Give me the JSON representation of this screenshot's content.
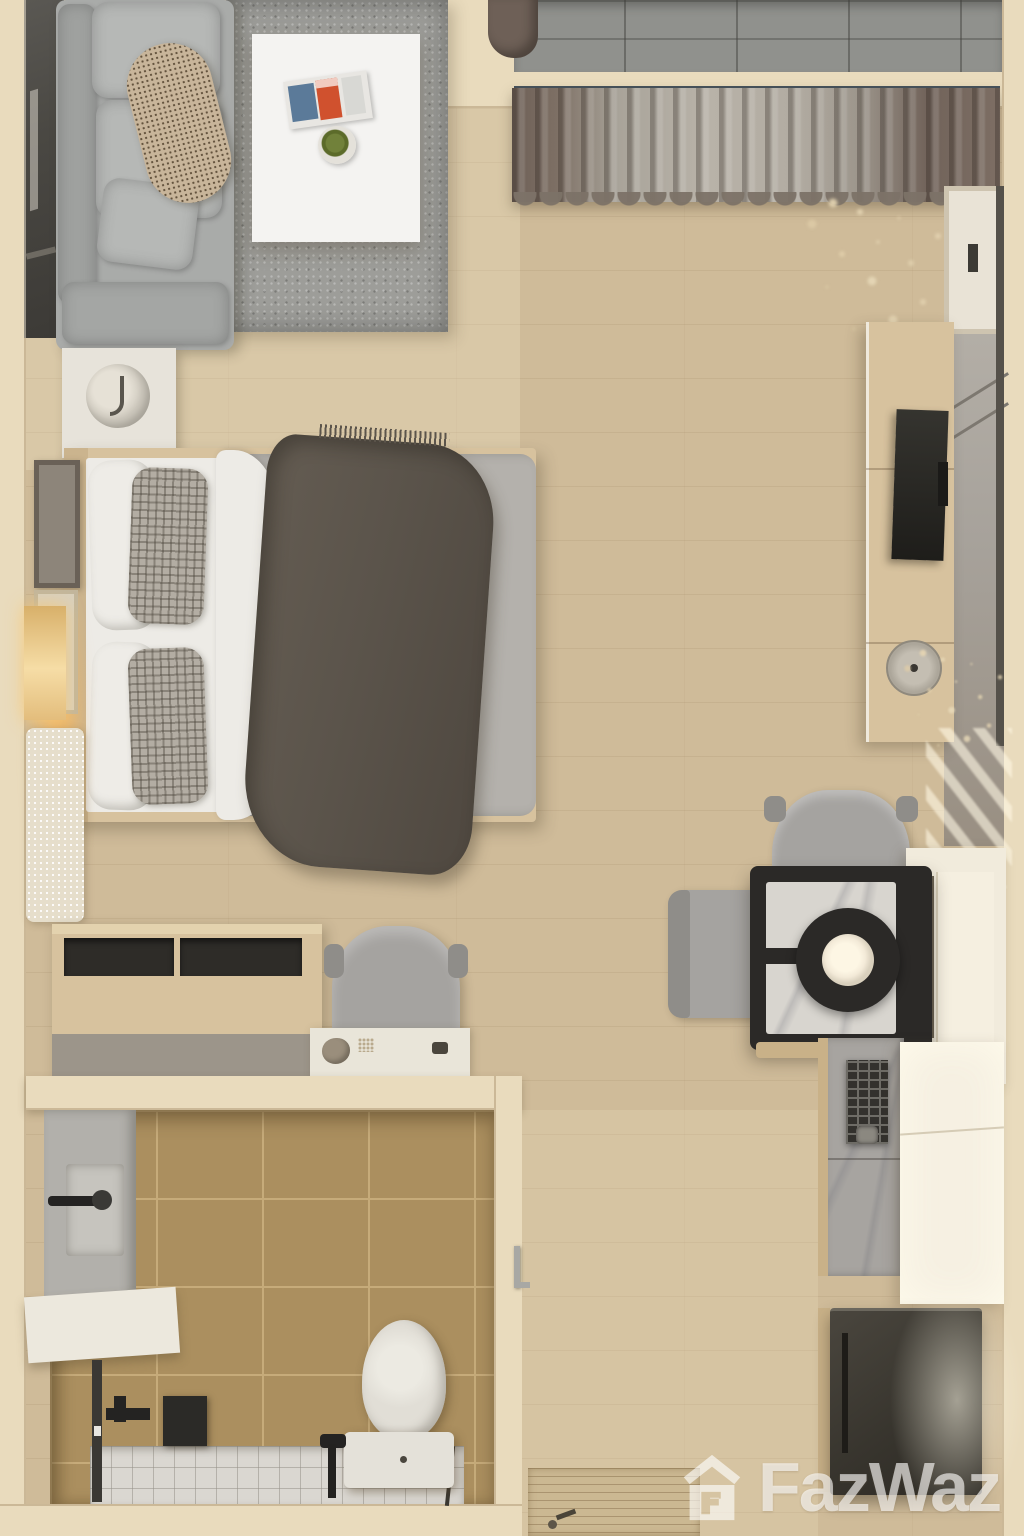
{
  "scene": {
    "type": "3d-floorplan-top-view",
    "description": "Top-down 3D render of a furnished studio apartment",
    "rooms": [
      {
        "id": "living-area",
        "label": "Living area with sofa, rug and coffee table"
      },
      {
        "id": "sleeping-area",
        "label": "Sleeping area with double bed and nightstand"
      },
      {
        "id": "balcony",
        "label": "Balcony with tiled floor and curtains"
      },
      {
        "id": "tv-wall",
        "label": "TV console and wardrobe wall"
      },
      {
        "id": "dining-area",
        "label": "Dining table with two chairs"
      },
      {
        "id": "kitchenette",
        "label": "Kitchenette with counter, stove, cabinet and fridge"
      },
      {
        "id": "bathroom",
        "label": "Bathroom with vanity, shower and toilet"
      },
      {
        "id": "entry",
        "label": "Entry corridor with doormat"
      }
    ],
    "objects": [
      "sofa",
      "area-rug",
      "coffee-table",
      "magazines",
      "potted-plant",
      "window-panel",
      "nightstand",
      "table-lamp",
      "double-bed",
      "white-pillows",
      "checkered-pillows",
      "gray-duvet",
      "dark-throw-blanket",
      "wall-art",
      "accent-light",
      "runner-rug",
      "sideboard",
      "desk-chair",
      "console-shelf",
      "dining-table",
      "pendant-bowl",
      "dining-chair-top",
      "dining-chair-left",
      "kitchen-island",
      "kitchen-counter",
      "gas-stove",
      "tall-cabinet",
      "refrigerator",
      "tv-console",
      "television",
      "decor-tray",
      "dried-plant",
      "wardrobe-door",
      "vanity-sink",
      "faucet",
      "shower-set",
      "toilet",
      "shower-glass",
      "entry-door-handle",
      "doormat",
      "curtains",
      "balcony-floor"
    ]
  },
  "watermark": {
    "brand": "FazWaz",
    "icon": "house-logo-icon",
    "color": "#ffffff",
    "opacity": 0.62
  },
  "palette": {
    "wall": "#e9dbbd",
    "floor": "#cfbb99",
    "rug": "#9d9d99",
    "sofa": "#a9aba9",
    "cushion": "#b6b8b6",
    "pillow-beige": "#c8b59a",
    "white-table": "#f4f3f1",
    "magazine-orange": "#d0512e",
    "magazine-blue": "#5b7a99",
    "plant-green": "#5c6b2a",
    "balcony-tile": "#90918d",
    "curtain-brown": "#6e6057",
    "curtain-gray": "#b8b2a8",
    "rod": "#46525c",
    "glass-dark": "#4a4843",
    "bed-wood": "#d7c29e",
    "sheet-white": "#edebe6",
    "duvet-gray": "#b4b1ac",
    "blanket-dark": "#5b544b",
    "check-pillow": "#b3ada3",
    "glow-warm": "#f0b35e",
    "art-frame": "#6a6157",
    "runner": "#e6decb",
    "desk-slot": "#2e2c28",
    "desk-base": "#9c958a",
    "chair-gray": "#a5a3a0",
    "chair-dark": "#8f8d89",
    "console-white": "#e9e5d9",
    "table-black": "#2b2927",
    "marble": "#d8d5cf",
    "bowl-cream": "#f3ead8",
    "island-white": "#f1ebdc",
    "counter-gray": "#a7a4a0",
    "grate-dark": "#33312d",
    "grate-line": "#6e6c66",
    "cabinet-bright": "#f6f0e2",
    "fridge": "#38352e",
    "wood-edge": "#c9b188",
    "bath-tile": "#ab8f5f",
    "bath-grout": "#c6ab7a",
    "bath-gray": "#b2b0ab",
    "counter-white": "#ece8dd",
    "fixture": "#242322",
    "toilet": "#e1ded6",
    "white-tile": "#dad7d1",
    "door-silver": "#a8a8a4",
    "mat": "#cbb892",
    "closet-gray": "#a7a29b",
    "door-white": "#e9e3d6"
  }
}
